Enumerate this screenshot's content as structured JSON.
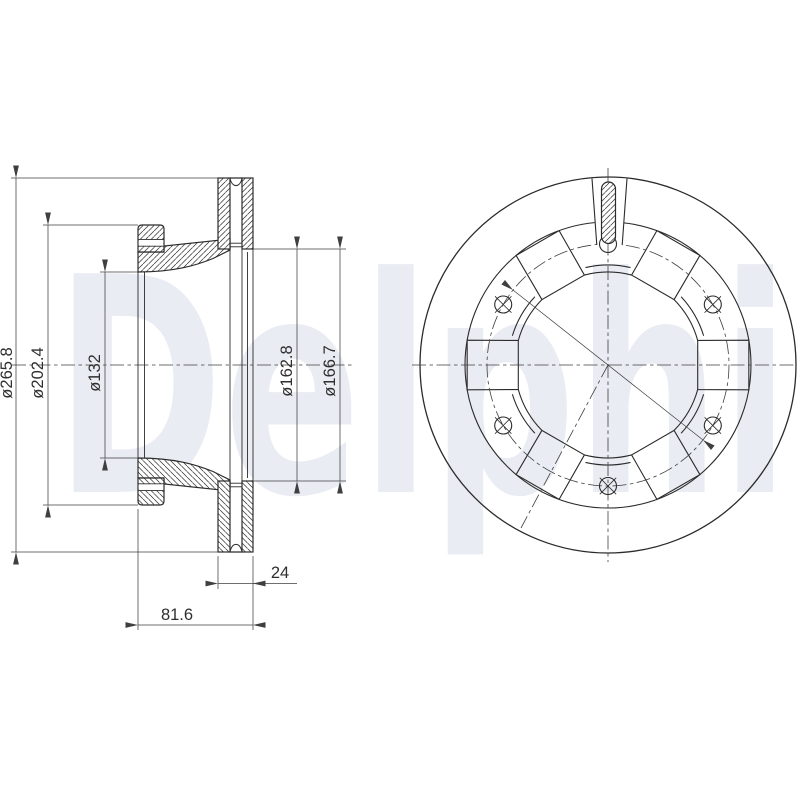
{
  "watermark": {
    "text": "Delphi",
    "color": "#e9ecf3"
  },
  "colors": {
    "line": "#2b2b2b",
    "thin_line": "#3f3f3f",
    "background": "#ffffff"
  },
  "section_view": {
    "dimensions": {
      "outer_diameter": "ø265.8",
      "flange_diameter": "ø202.4",
      "bore_diameter": "ø132",
      "friction_inner_diameter_1": "ø162.8",
      "friction_inner_diameter_2": "ø166.7",
      "disc_thickness": "24",
      "total_height": "81.6"
    }
  },
  "front_view": {
    "bolt_hole_count": 6,
    "window_count": 6
  }
}
